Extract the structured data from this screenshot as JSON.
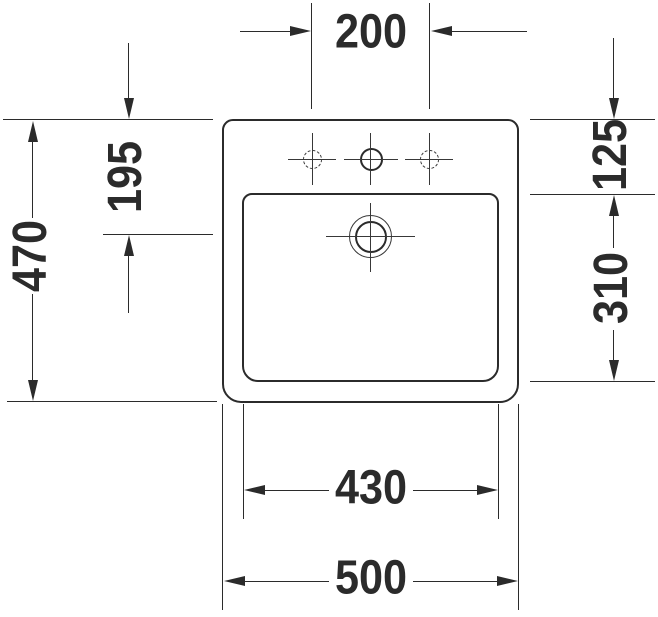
{
  "drawing": {
    "kind": "washbasin-dimension-drawing-top-view",
    "background_color": "#ffffff",
    "line_color": "#2b2b2b",
    "dims": {
      "faucet_hole_spacing": "200",
      "tap_platform_depth": "195",
      "overall_depth": "470",
      "rim_to_bowl_front": "125",
      "bowl_depth": "310",
      "bowl_width": "430",
      "overall_width": "500"
    },
    "features": [
      "faucet-hole-left-dashed",
      "faucet-hole-center",
      "faucet-hole-right-dashed",
      "drain-symbol"
    ]
  }
}
